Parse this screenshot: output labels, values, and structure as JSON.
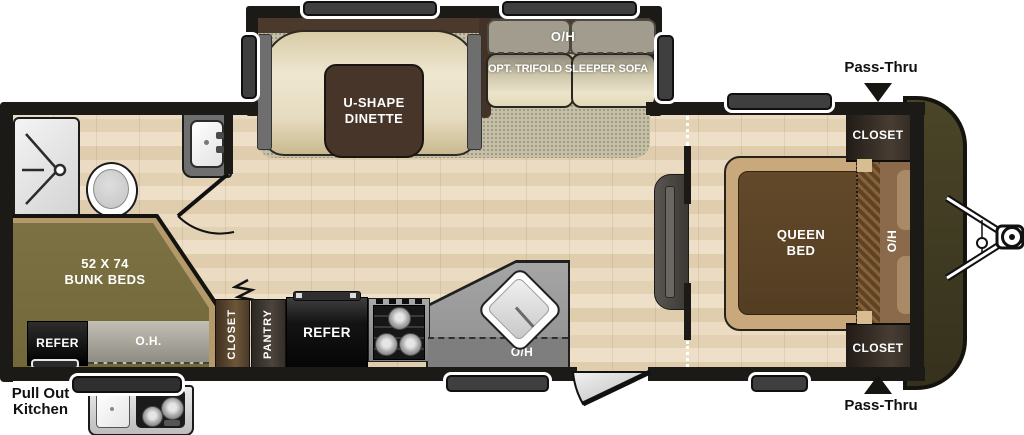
{
  "labels": {
    "dinette": "U-SHAPE\nDINETTE",
    "sofa_overhead": "O/H",
    "sofa": "OPT. TRIFOLD SLEEPER SOFA",
    "bunks": "52 X 74\nBUNK BEDS",
    "bunk_refer": "REFER",
    "bunk_overhead": "O.H.",
    "galley_closet": "CLOSET",
    "galley_pantry": "PANTRY",
    "galley_refer": "REFER",
    "galley_overhead": "O/H",
    "queen_bed": "QUEEN\nBED",
    "bed_overhead": "O/H",
    "closet_front_top": "CLOSET",
    "closet_front_bottom": "CLOSET",
    "pass_thru_top": "Pass-Thru",
    "pass_thru_bottom": "Pass-Thru",
    "pull_out_kitchen": "Pull Out\nKitchen"
  },
  "colors": {
    "wall": "#1c1a17",
    "carpet": "#c6c0a8",
    "cream": "#ece4cb",
    "table": "#463528",
    "olive": "#786d41",
    "trim": "#b49a6a",
    "bed": "#5a4226",
    "platform": "#c9a87c",
    "headboard": "#8a6a4a",
    "cap": "#413d22"
  }
}
